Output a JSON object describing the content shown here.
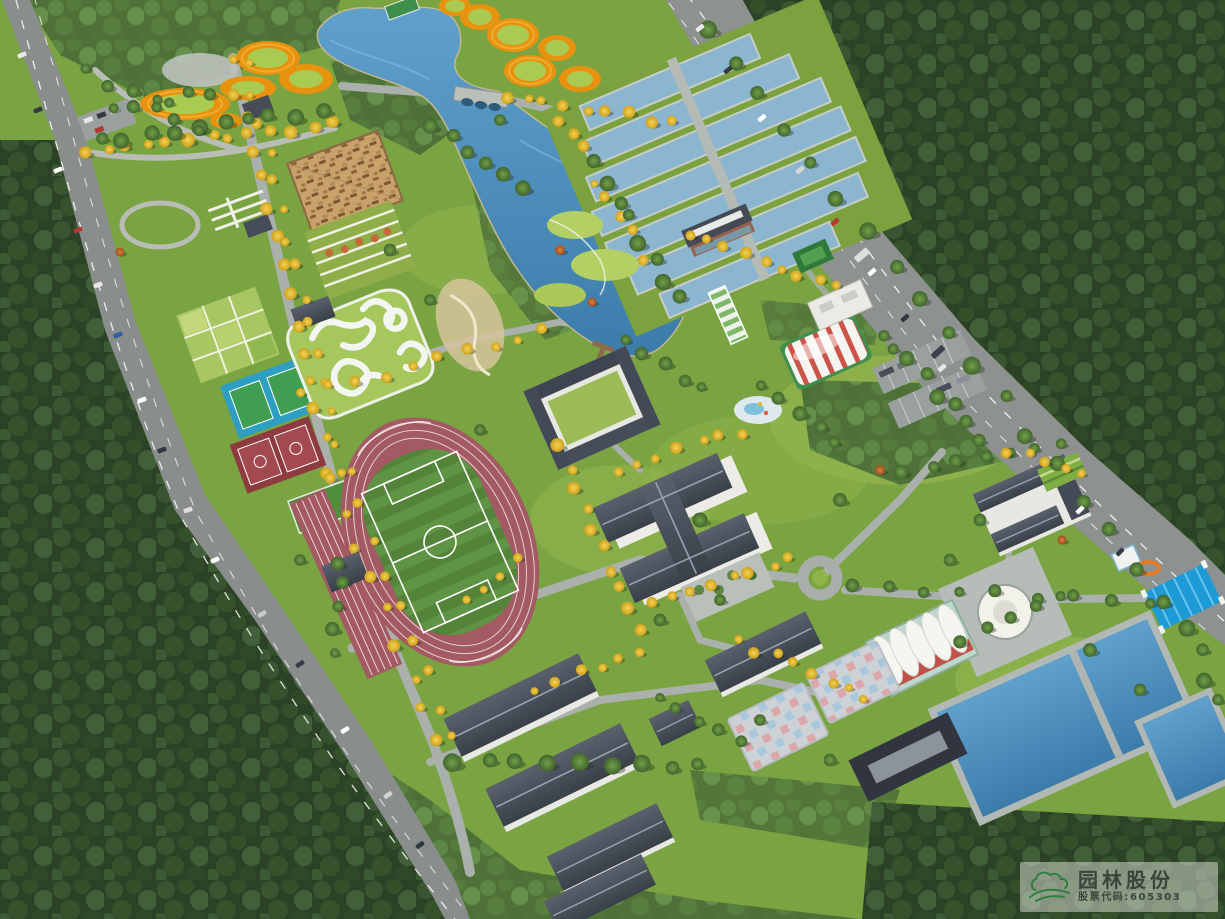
{
  "meta": {
    "type": "aerial-architectural-rendering",
    "subject": "bird's-eye masterplan rendering of a sports park and campus between two tree-lined arterial roads"
  },
  "watermark": {
    "company_name": "园林股份",
    "stock_code_label": "股票代码:605303",
    "logo_icon": "cloud-hill-logo",
    "logo_color": "#2f7d3f",
    "text_color": "#3c453c",
    "background": "rgba(225,227,219,0.5)"
  },
  "palette": {
    "forest_dark": "#2c4226",
    "grove_green": "#4f7239",
    "lawn": "#7aa341",
    "lawn_highlight": "#a3c258",
    "lake_water": "#4e8fc0",
    "pool_water": "#8cb6d0",
    "road_asphalt": "#898e8c",
    "lane_marking": "#ffffff",
    "running_track": "#a35a63",
    "soccer_field": "#5e9443",
    "ring_orange": "#e8930f",
    "ring_lawn": "#aacb52",
    "roof_slate": "#424854",
    "wall_white": "#efefe9",
    "pavilion_wood": "#c9a26b",
    "air_dome_red": "#cc5348",
    "canopy_blue": "#1e9ad6",
    "tree_yellow": "#e3b82e",
    "tree_green": "#4e7a38",
    "tennis_blue": "#2e9fc0",
    "basketball_red": "#8e3b40",
    "checker_pink": "#dca7ab",
    "checker_blue": "#a9c8de"
  },
  "scene": {
    "features": [
      "perimeter-road-west",
      "perimeter-road-east",
      "forest-belt",
      "central-lake",
      "arch-bridge",
      "ring-gardens",
      "water-treatment-pools",
      "pump-house",
      "timber-pavilion",
      "pergola",
      "terraced-garden",
      "community-plots",
      "tennis-courts",
      "basketball-courts",
      "pump-track",
      "athletics-stadium",
      "soccer-field",
      "courtyard-building",
      "main-hall",
      "air-dome-sports-hall",
      "dry-slide",
      "splash-pad",
      "parking-lots",
      "roundabout",
      "heritage-courtyard",
      "circular-plaza",
      "membrane-pavilion",
      "blue-canopy",
      "reservoir-ponds",
      "dormitory-buildings",
      "checkerboard-courts",
      "street-trees"
    ]
  }
}
